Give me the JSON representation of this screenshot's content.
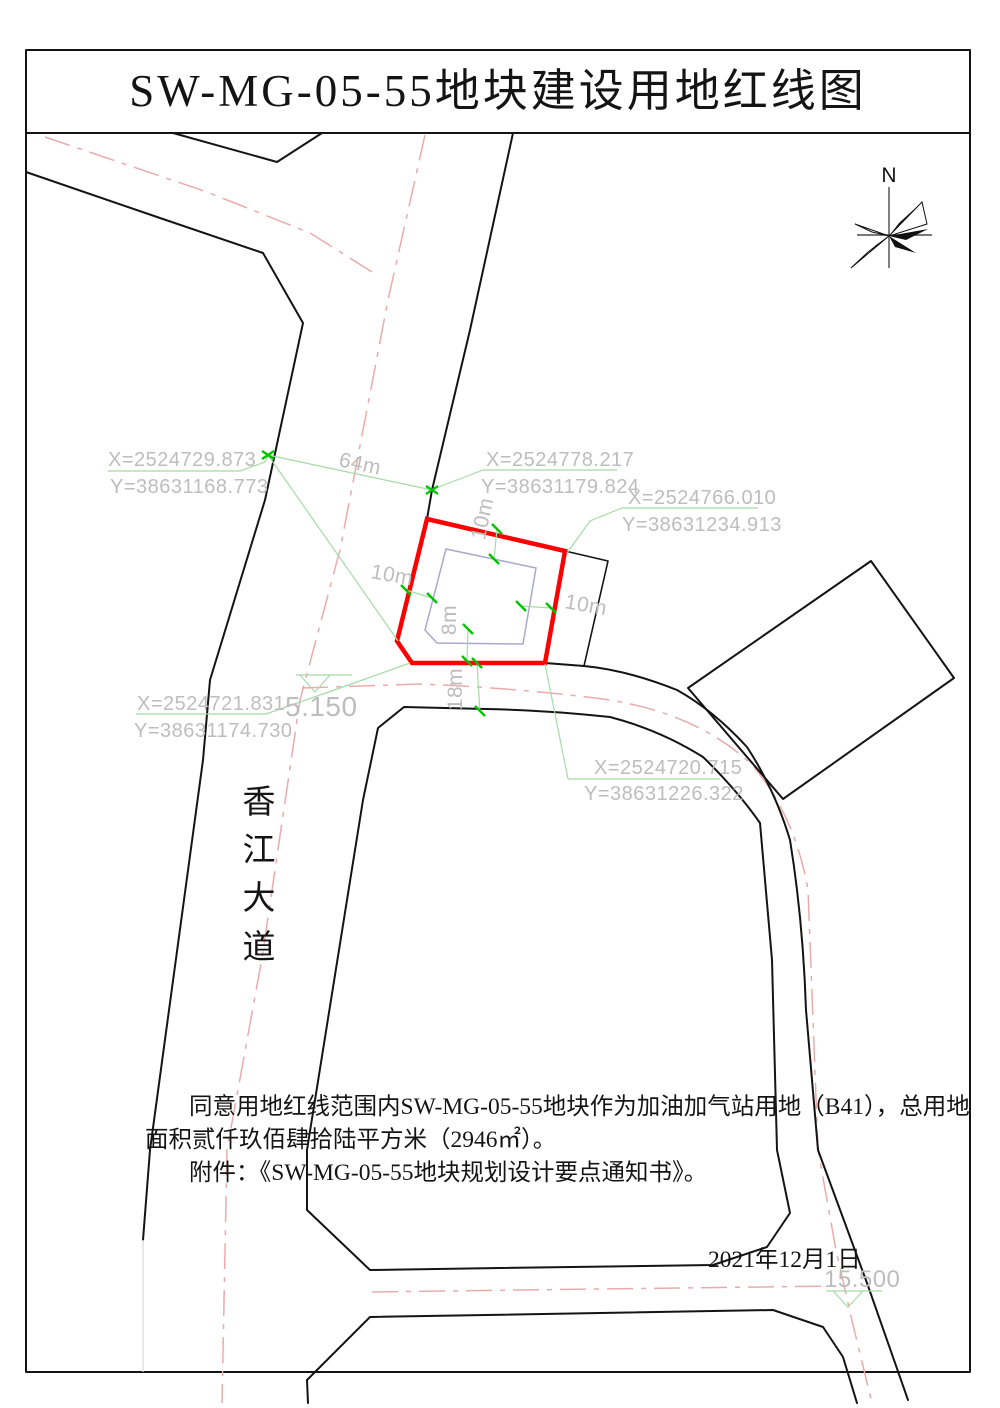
{
  "title": "SW-MG-05-55地块建设用地红线图",
  "compass": {
    "label": "N"
  },
  "road_name": {
    "chars": [
      "香",
      "江",
      "大",
      "道"
    ]
  },
  "coordinate_labels": [
    {
      "x": "X=2524729.873",
      "y": "Y=38631168.773"
    },
    {
      "x": "X=2524778.217",
      "y": "Y=38631179.824"
    },
    {
      "x": "X=2524766.010",
      "y": "Y=38631234.913"
    },
    {
      "x": "X=2524721.831",
      "y": "Y=38631174.730"
    },
    {
      "x": "X=2524720.715",
      "y": "Y=38631226.322"
    }
  ],
  "dimensions": {
    "avenue_width": "64m",
    "setback_top": "10m",
    "setback_left": "10m",
    "setback_right": "10m",
    "setback_bottom": "8m",
    "side_road_width": "18m"
  },
  "elevations": {
    "south": "5.150",
    "east": "15.500"
  },
  "notes": {
    "line1": "同意用地红线范围内SW-MG-05-55地块作为加油加气站用地（B41），总用地",
    "line2": "面积贰仟玖佰肆拾陆平方米（2946㎡）。",
    "line3": "附件：《SW-MG-05-55地块规划设计要点通知书》。"
  },
  "date": "2021年12月1日",
  "colors": {
    "red_line": "#ff0000",
    "tick_green": "#00c400",
    "leader_green": "#a5dba5",
    "centerline_pink": "#eaabab",
    "dim_text_gray": "#bdbdbd",
    "setback_line": "#a9a9cc",
    "ink": "#141414"
  }
}
